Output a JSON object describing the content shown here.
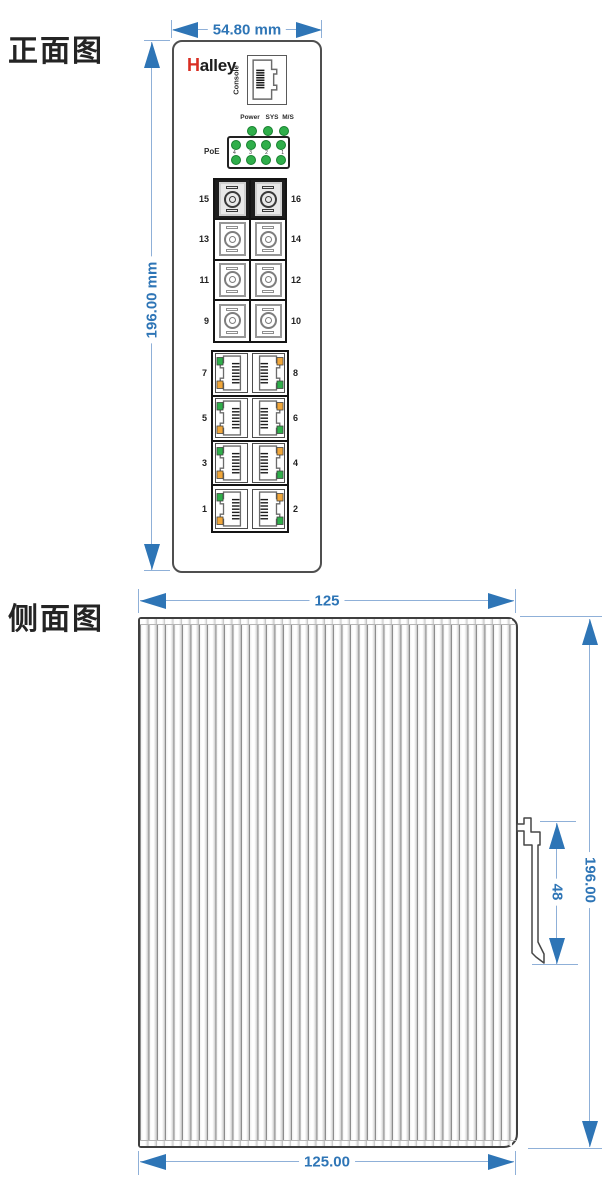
{
  "front_view": {
    "title": "正面图",
    "width_dim": "54.80 mm",
    "height_dim": "196.00 mm",
    "brand": {
      "mark": "H",
      "name": "alley"
    },
    "console_label": "Console",
    "led_panel": {
      "status_labels": [
        "Power",
        "SYS",
        "M/S"
      ],
      "poe_label": "PoE",
      "row1_numbers": [
        "4",
        "3",
        "2",
        "1"
      ]
    },
    "fiber_rows": [
      {
        "left": "15",
        "right": "16",
        "dark": true
      },
      {
        "left": "13",
        "right": "14",
        "dark": false
      },
      {
        "left": "11",
        "right": "12",
        "dark": false
      },
      {
        "left": "9",
        "right": "10",
        "dark": false
      }
    ],
    "rj45_rows": [
      {
        "left": "7",
        "right": "8"
      },
      {
        "left": "5",
        "right": "6"
      },
      {
        "left": "3",
        "right": "4"
      },
      {
        "left": "1",
        "right": "2"
      }
    ]
  },
  "side_view": {
    "title": "侧面图",
    "top_dim": "125",
    "bottom_dim": "125.00",
    "height_dim": "196.00",
    "clip_dim": "48"
  },
  "colors": {
    "dimension_line": "#8fb0d8",
    "dimension_accent": "#2e75b6",
    "led_green": "#2fae4a",
    "led_orange": "#f0a63a",
    "logo_red": "#d92e23",
    "device_outline": "#4f4f4f"
  }
}
